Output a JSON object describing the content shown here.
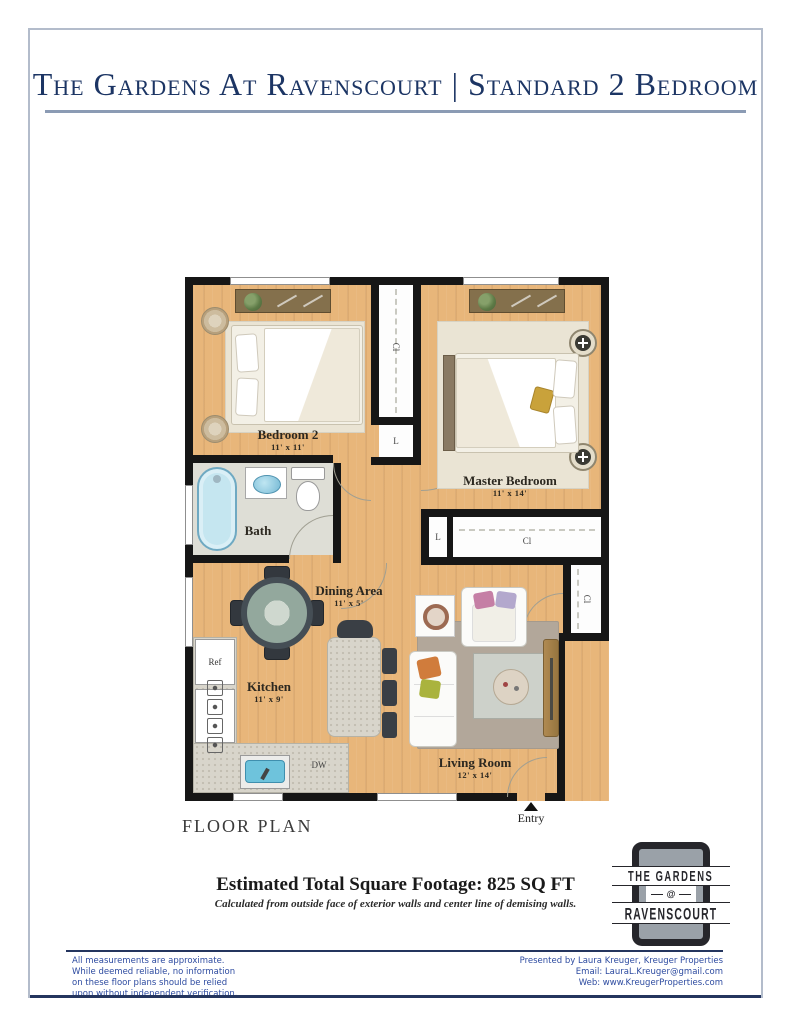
{
  "title": {
    "text": "The Gardens At Ravenscourt | Standard 2 Bedroom"
  },
  "floor_plan": {
    "section_label": "FLOOR PLAN",
    "entry_label": "Entry",
    "rooms": {
      "bedroom2": {
        "name": "Bedroom 2",
        "dims": "11' x 11'"
      },
      "master": {
        "name": "Master Bedroom",
        "dims": "11' x 14'"
      },
      "bath": {
        "name": "Bath"
      },
      "dining": {
        "name": "Dining Area",
        "dims": "11' x 5'"
      },
      "kitchen": {
        "name": "Kitchen",
        "dims": "11' x 9'"
      },
      "living": {
        "name": "Living Room",
        "dims": "12' x 14'"
      }
    },
    "labels": {
      "closet": "Cl",
      "linen": "L",
      "refrigerator": "Ref",
      "dishwasher": "DW"
    }
  },
  "footage": {
    "total": "Estimated Total Square Footage: 825 SQ FT",
    "note": "Calculated from outside face of exterior walls and center line of demising walls."
  },
  "logo": {
    "line1": "THE GARDENS",
    "line2": "@",
    "line3": "RAVENSCOURT"
  },
  "footer": {
    "disclaimer": [
      "All measurements are approximate.",
      "While deemed reliable, no information",
      "on these floor plans should be relied",
      "upon without independent verification."
    ],
    "contact": [
      "Presented by Laura Kreuger, Kreuger Properties",
      "Email: LauraL.Kreuger@gmail.com",
      "Web: www.KreugerProperties.com"
    ]
  },
  "colors": {
    "title_navy": "#1c3564",
    "rule_blue": "#8b9bb4",
    "footer_blue": "#2d4ba0",
    "wall": "#161616",
    "wood": "#e8b67a",
    "water_blue": "#7fc6de",
    "logo_dark": "#26262b",
    "logo_gray": "#9aa1a8"
  }
}
